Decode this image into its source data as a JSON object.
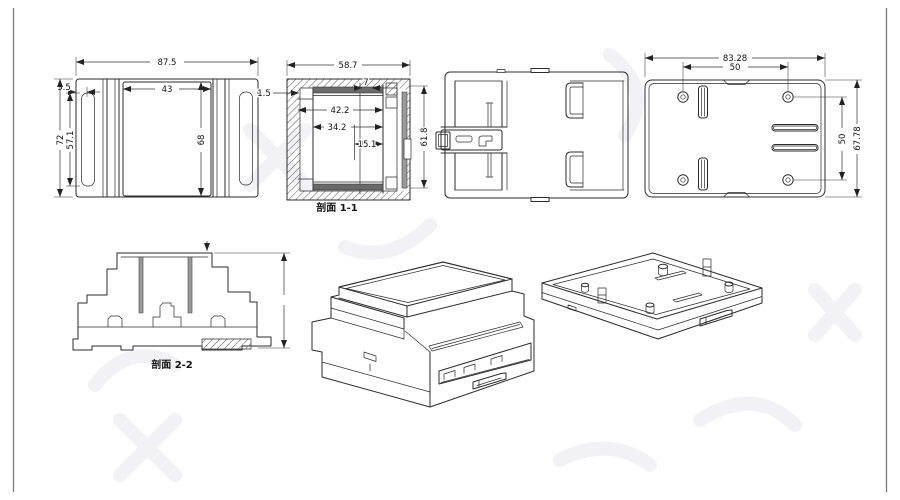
{
  "drawing": {
    "front_view": {
      "dim_width": "87.5",
      "dim_edge_offset": "5.5",
      "dim_inner_width": "43",
      "dim_height": "72",
      "dim_slot_height": "57.1",
      "dim_lid_height": "68"
    },
    "section_view_1": {
      "label": "剖面 1-1",
      "dim_width": "58.7",
      "dim_wall_thickness": "1.5",
      "dim_step": "7",
      "dim_inner_width_a": "42.2",
      "dim_inner_width_b": "34.2",
      "dim_inner_width_c": "15.1",
      "dim_height": "61.8"
    },
    "back_view": {
      "dim_width": "83.28",
      "dim_hole_spacing_h": "50",
      "dim_hole_spacing_v": "50",
      "dim_height": "67.78"
    },
    "section_view_2": {
      "label": "剖面 2-2"
    },
    "colors": {
      "line": "#2b2b2b",
      "dim_line": "#333333",
      "hatch": "#555555",
      "background": "#ffffff",
      "frame_border": "#7a7a7a",
      "watermark": "#f2f2f6"
    }
  }
}
